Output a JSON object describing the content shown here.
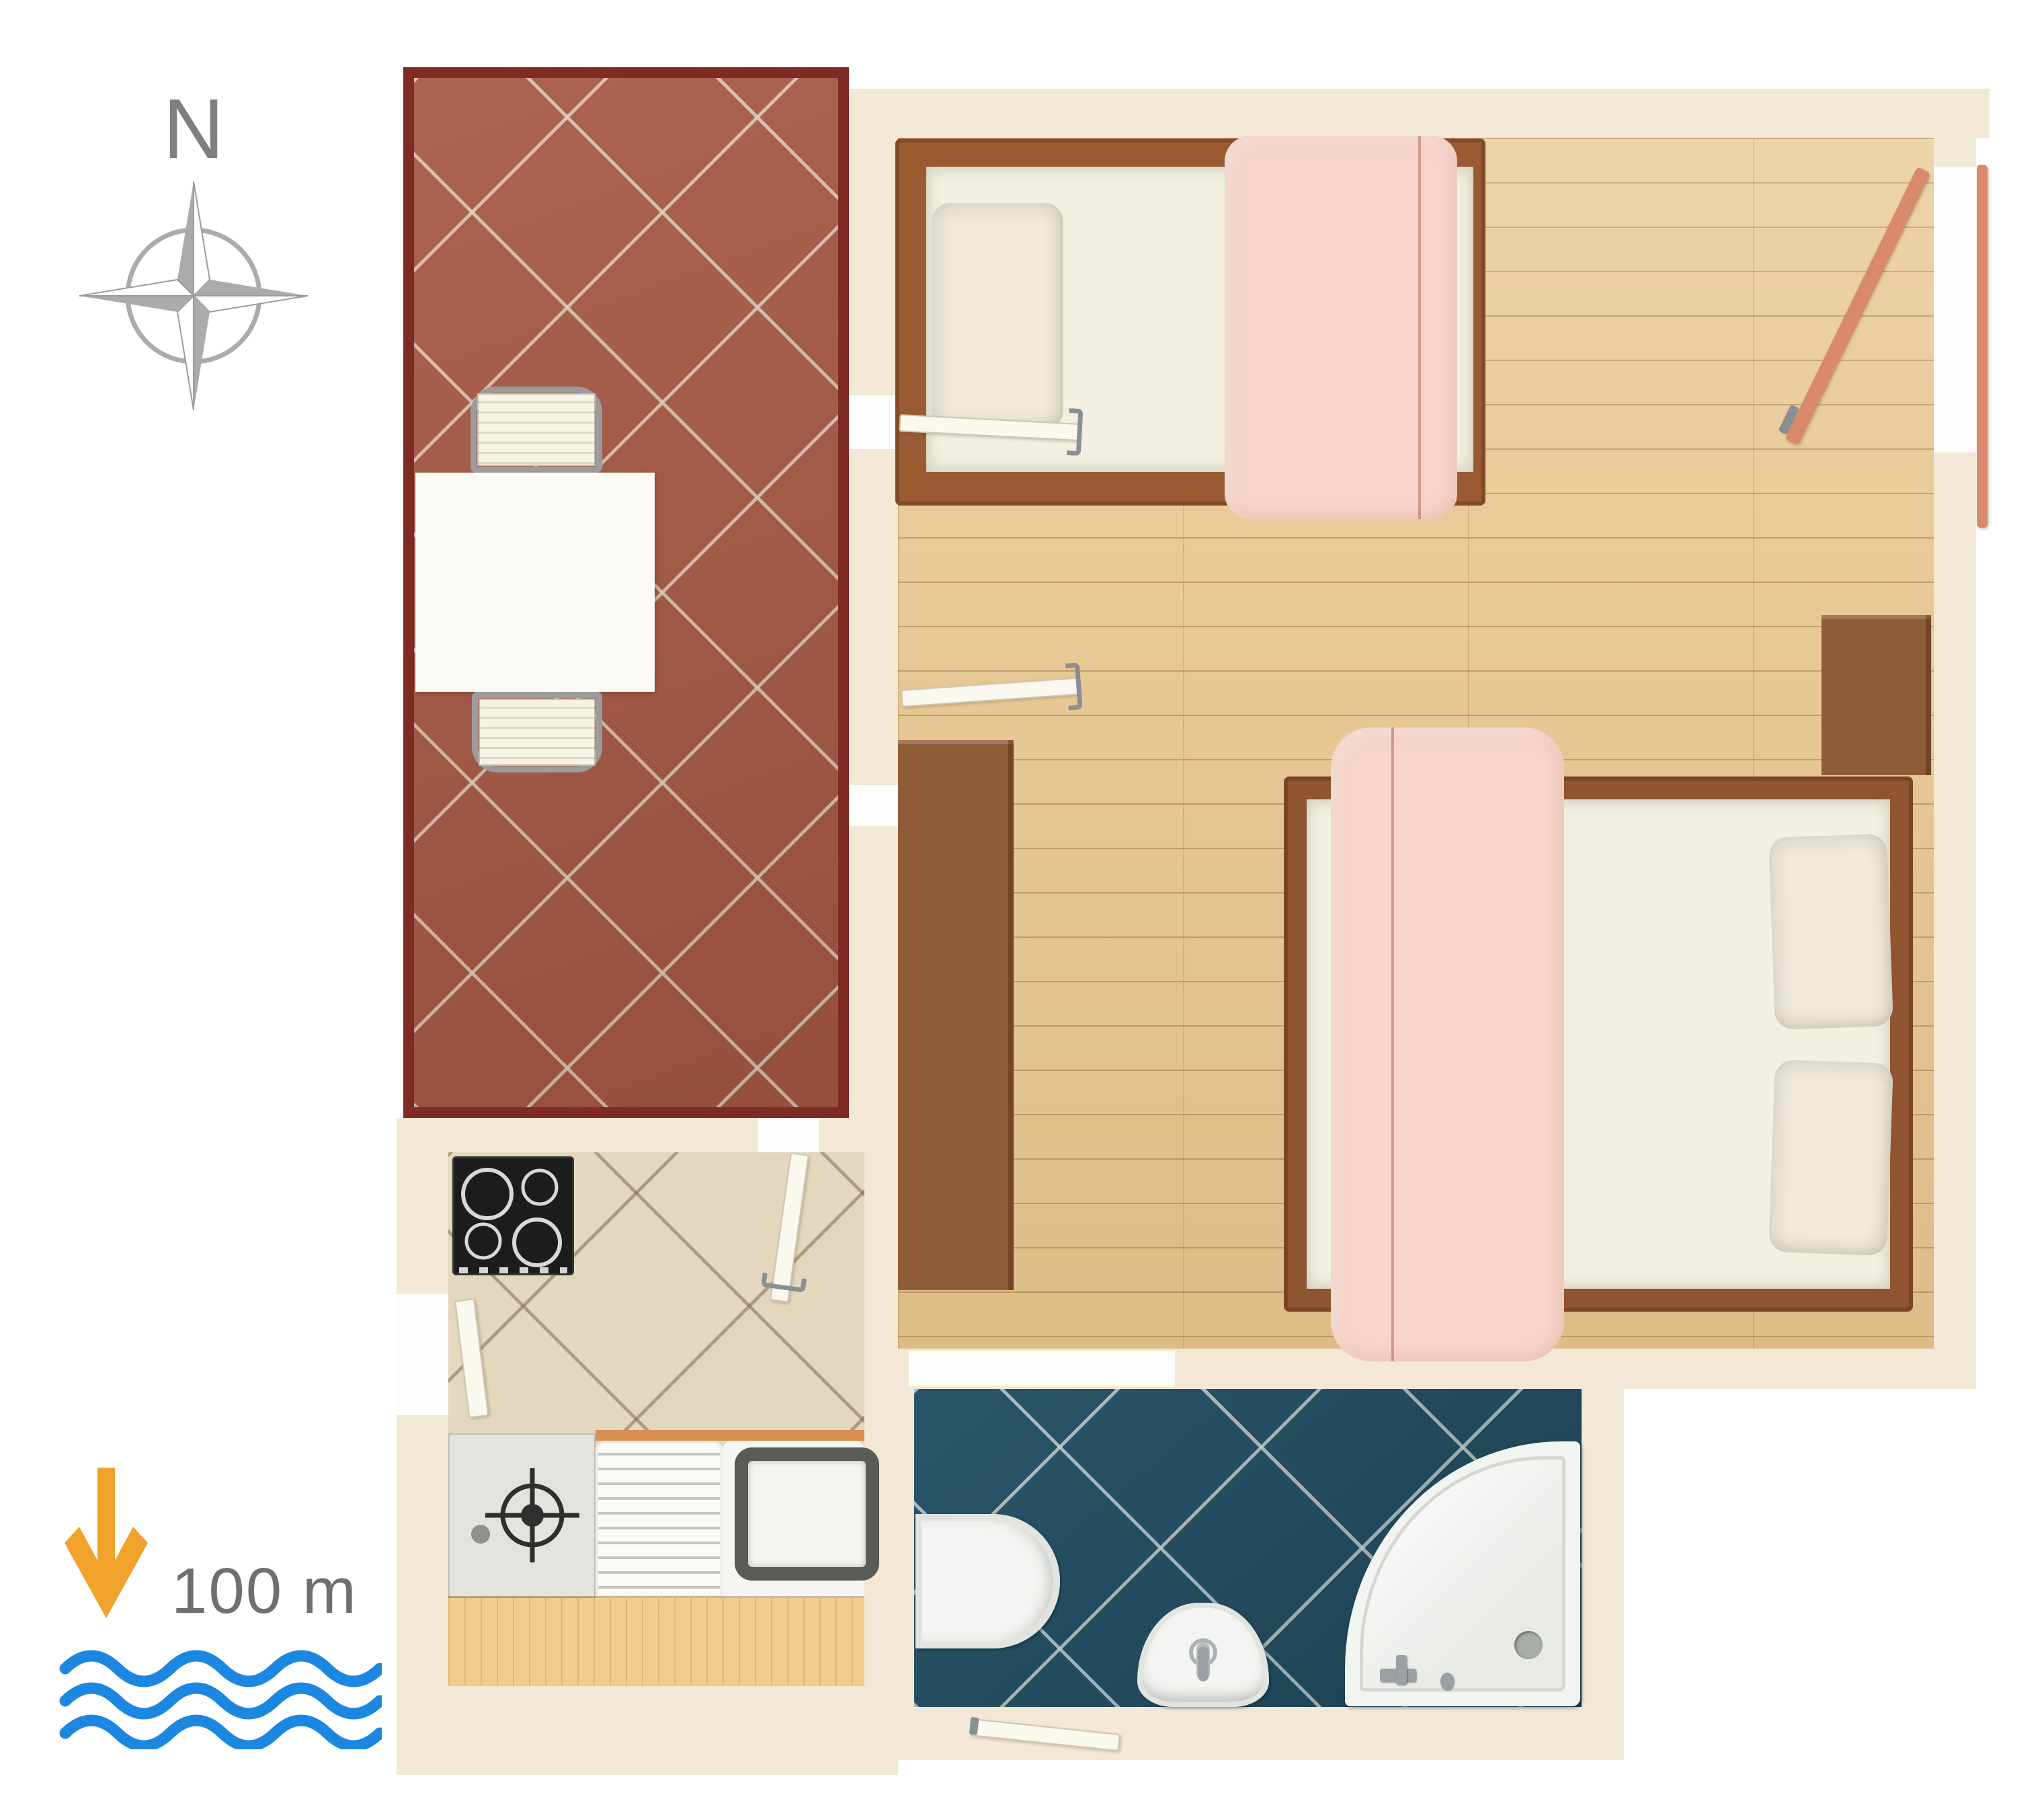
{
  "legend": {
    "north_label": "N",
    "distance_label": "100 m"
  },
  "colors": {
    "page-bg": "#FFFFFF",
    "wall": "#F3E8D6",
    "terrace-border": "#7E2B26",
    "terrace-tile": "#A65843",
    "wood-floor": "#E9CA97",
    "kitchen-tile": "#E3D7BD",
    "bath-tile": "#1F4C60",
    "counter-wood": "#F0CD8C",
    "blanket-pink": "#F7D5CA",
    "mattress": "#F3F0E2",
    "bed-frame": "#9A5B33",
    "furniture-brown": "#8F5B36",
    "door-salmon": "#D98A6B",
    "door-white": "#FBF8F0",
    "handle-gray": "#8A8F94",
    "compass-gray": "#ABABAB",
    "north-text": "#7F7F7F",
    "arrow-orange": "#F0A22B",
    "wave-blue": "#1B87E0",
    "scale-text": "#6F6F6F",
    "appliance-black": "#1C1C1C"
  },
  "plan": {
    "type": "apartment-floor-plan",
    "rooms": [
      "terrace",
      "bedroom",
      "kitchen",
      "bathroom"
    ],
    "furniture": [
      "dining-table",
      "chair",
      "chair",
      "single-bed",
      "double-bed",
      "desk",
      "nightstand",
      "stove",
      "kitchen-counter",
      "kitchen-sink",
      "dish-drainer",
      "bathtub",
      "bidet",
      "corner-shower",
      "entry-door",
      "interior-doors"
    ],
    "orientation": "north-up",
    "distance_to_water": "100 m"
  }
}
